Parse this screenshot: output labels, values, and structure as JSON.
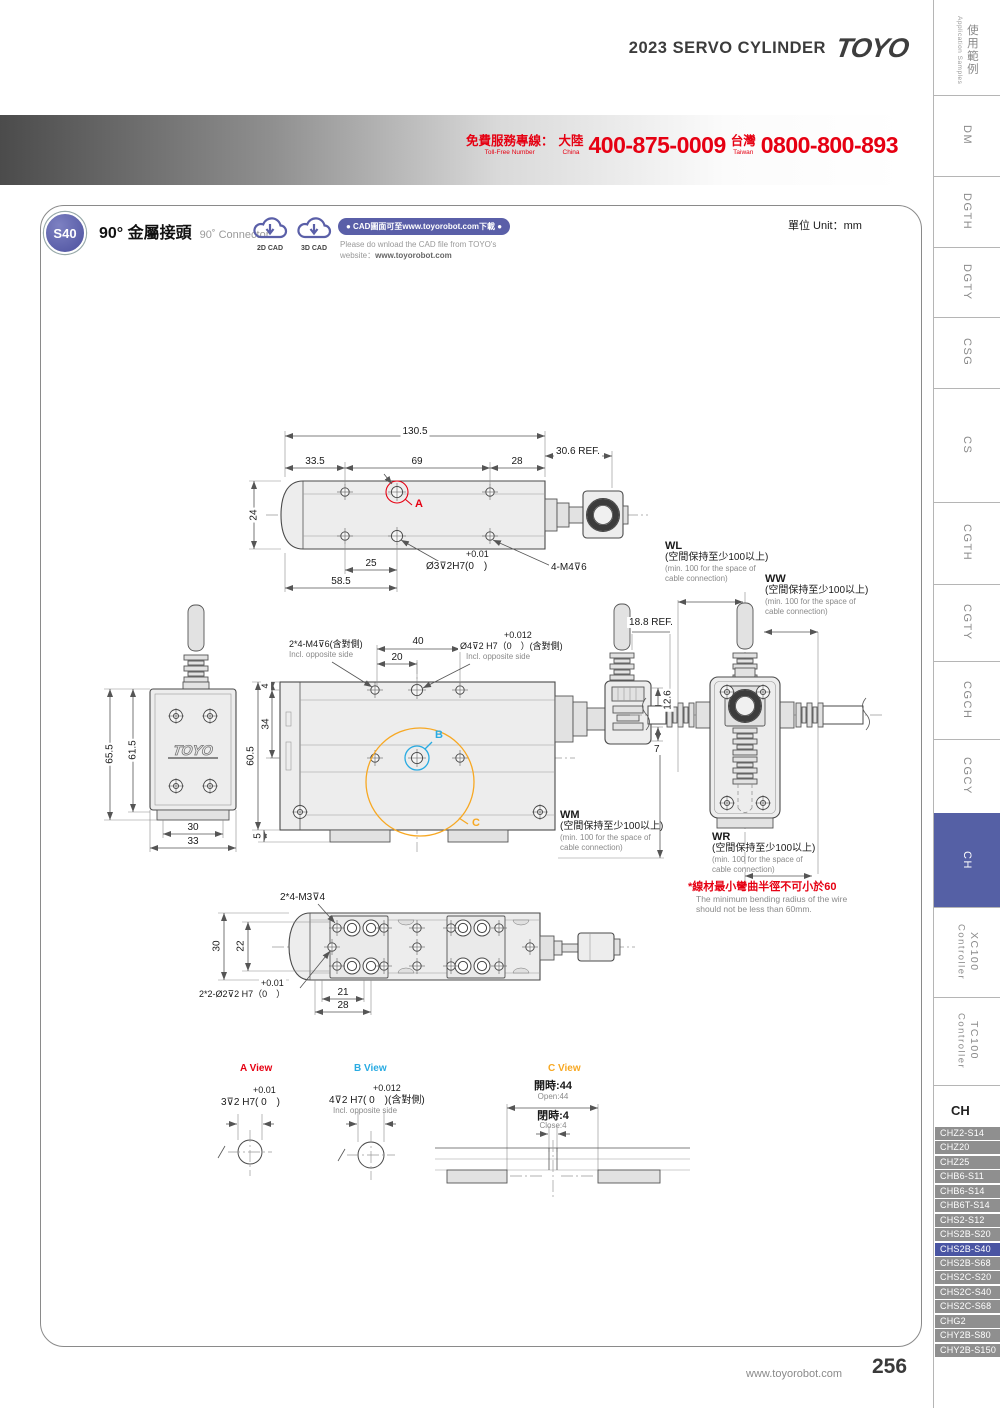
{
  "page": {
    "header_title": "2023 SERVO CYLINDER",
    "brand": "TOYO",
    "unit_label": "單位 Unit：mm",
    "footer_url": "www.toyorobot.com",
    "page_number": "256",
    "tollfree": {
      "label_cn": "免費服務專線：",
      "label_en": "Toll-Free Number",
      "region1_cn": "大陸",
      "region1_en": "China",
      "number1": "400-875-0009",
      "region2_cn": "台灣",
      "region2_en": "Taiwan",
      "number2": "0800-800-893"
    }
  },
  "product": {
    "code": "S40",
    "title_cn": "90° 金屬接頭",
    "title_en": "90˚ Connector",
    "cad_2d": "2D CAD",
    "cad_3d": "3D CAD",
    "cad_pill": "● CAD圖面可至www.toyorobot.com下載 ●",
    "cad_note1": "Please do wnload the CAD file from TOYO's",
    "cad_note2_prefix": "website：",
    "cad_note2_url": "www.toyorobot.com"
  },
  "sidebar": {
    "tabs": [
      {
        "label": "使用範例",
        "sub": "Application Samples"
      },
      {
        "label": "DM"
      },
      {
        "label": "DGTH"
      },
      {
        "label": "DGTY"
      },
      {
        "label": "CSG"
      },
      {
        "label": "CS"
      },
      {
        "label": "CGTH"
      },
      {
        "label": "CGTY"
      },
      {
        "label": "CGCH"
      },
      {
        "label": "CGCY"
      },
      {
        "label": "CH"
      },
      {
        "label": "XC100",
        "sub": "Controller"
      },
      {
        "label": "TC100",
        "sub": "Controller"
      }
    ],
    "active_tab": "CH",
    "group_label": "CH",
    "models": [
      "CHZ2-S14",
      "CHZ20",
      "CHZ25",
      "CHB6-S11",
      "CHB6-S14",
      "CHB6T-S14",
      "CHS2-S12",
      "CHS2B-S20",
      "CHS2B-S40",
      "CHS2B-S68",
      "CHS2C-S20",
      "CHS2C-S40",
      "CHS2C-S68",
      "CHG2",
      "CHY2B-S80",
      "CHY2B-S150"
    ],
    "active_model": "CHS2B-S40"
  },
  "views": {
    "top": {
      "total": "130.5",
      "ref": "30.6 REF.",
      "a": "33.5",
      "b": "69",
      "c": "28",
      "h": "24",
      "e": "25",
      "f": "58.5",
      "hole_tol": "+0.01",
      "hole": "Ø3⊽2H7(0　)",
      "thread": "4-M4⊽6",
      "callout": "A"
    },
    "front": {
      "h1": "65.5",
      "h2": "61.5",
      "w1": "30",
      "w2": "33",
      "logo": "TOYO"
    },
    "plan": {
      "thread": "2*4-M4⊽6(含對側)",
      "thread_en": "Incl. opposite side",
      "d40": "40",
      "d20": "20",
      "hole_tol": "+0.012",
      "hole": "Ø4⊽2 H7（0　）(含對側)",
      "hole_en": "Incl. opposite side",
      "ref": "18.8 REF.",
      "d126": "12.6",
      "d7": "7",
      "d4": "4",
      "d34": "34",
      "d605": "60.5",
      "d5": "5",
      "callout_b": "B",
      "callout_c": "C"
    },
    "spaces": {
      "wm": "WM",
      "wl": "WL",
      "ww": "WW",
      "wr": "WR",
      "cn": "(空間保持至少100以上)",
      "en1": "(min. 100 for the space of",
      "en2": "cable connection)"
    },
    "warning": {
      "cn": "*線材最小彎曲半徑不可小於60",
      "en1": "The minimum bending radius of the wire",
      "en2": "should not be less than 60mm."
    },
    "bottom": {
      "thread": "2*4-M3⊽4",
      "d30": "30",
      "d22": "22",
      "d21": "21",
      "d28": "28",
      "hole_tol": "+0.01",
      "hole": "2*2-Ø2⊽2 H7（0　）"
    },
    "detail_a": {
      "title": "A View",
      "tol": "+0.01",
      "label": "3⊽2 H7( 0　)"
    },
    "detail_b": {
      "title": "B View",
      "tol": "+0.012",
      "label": "4⊽2 H7( 0　)(含對側)",
      "en": "Incl. opposite side"
    },
    "detail_c": {
      "title": "C View",
      "open_cn": "開時:44",
      "open_en": "Open:44",
      "close_cn": "閉時:4",
      "close_en": "Close:4"
    }
  },
  "colors": {
    "accent_red": "#e60012",
    "brand_purple": "#5a5fa8",
    "callout_blue": "#29abe2",
    "callout_orange": "#f7a823",
    "sidebar_active": "#5560a5",
    "model_active": "#4a55a3",
    "model_item": "#8f8f8f"
  }
}
